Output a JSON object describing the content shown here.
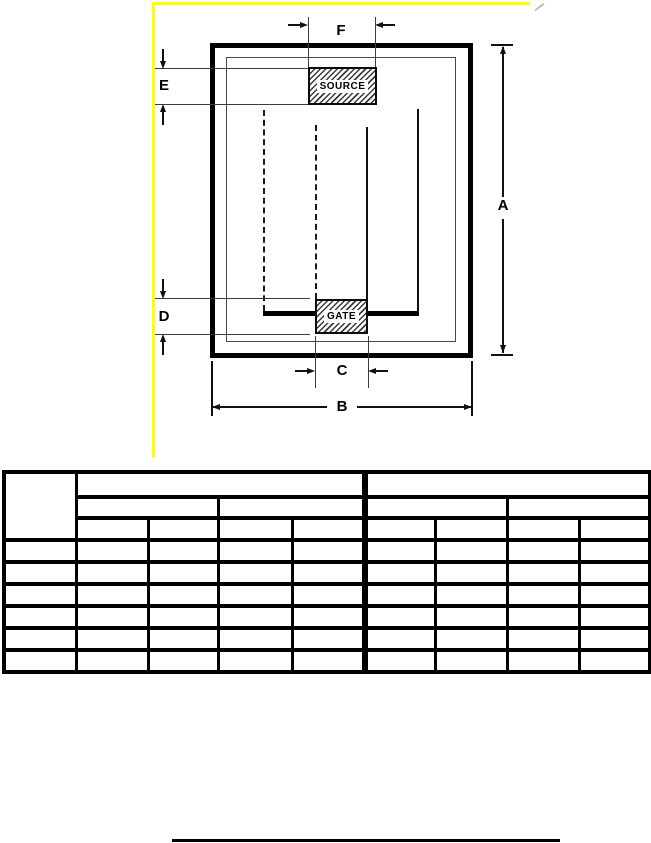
{
  "diagram": {
    "source_pad_label": "SOURCE",
    "gate_pad_label": "GATE",
    "dim_a": "A",
    "dim_b": "B",
    "dim_c": "C",
    "dim_d": "D",
    "dim_e": "E",
    "dim_f": "F",
    "highlight_color": "#ffff00"
  },
  "table": {
    "columns": 9,
    "header_rows": 3,
    "data_rows": 6,
    "cells_empty": true
  }
}
